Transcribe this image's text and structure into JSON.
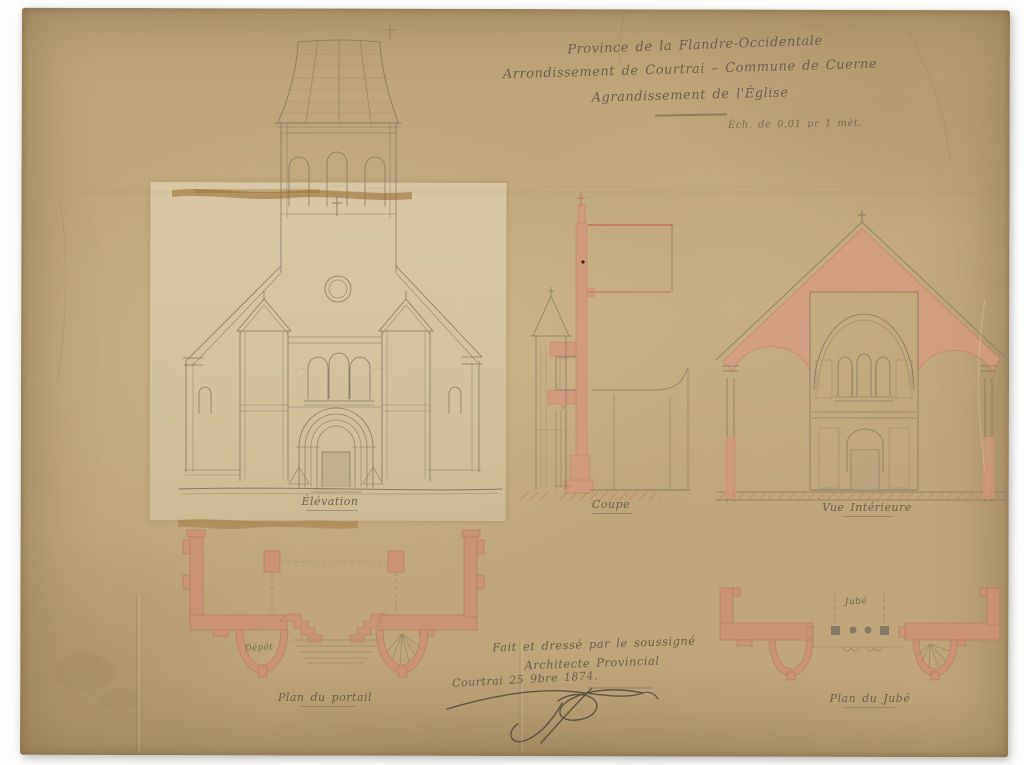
{
  "document_type": "architectural-drawing-scan",
  "titles": {
    "line1": "Province de la Flandre-Occidentale",
    "line2": "Arrondissement de Courtrai – Commune de Cuerne",
    "line3": "Agrandissement de l'Église",
    "scale_note": "Éch. de 0,01 pr 1 mèt."
  },
  "labels": {
    "elevation": "Élévation",
    "coupe": "Coupe",
    "vue_interieure": "Vue Intérieure",
    "plan_portail": "Plan du portail",
    "plan_jube": "Plan du Jubé",
    "depot": "Dépôt",
    "jube": "Jubé"
  },
  "attestation": {
    "line1": "Fait et dressé par le soussigné",
    "line2": "Architecte Provincial",
    "date": "Courtrai 25 9bre 1874."
  },
  "colors": {
    "paper": "#bfa67b",
    "pasted_panel": "#d8c9a6",
    "wash_pink": "#d5987e",
    "pencil": "#847a68",
    "ink": "#5f564a",
    "tape_stain": "#9b7334",
    "background": "#ffffff"
  }
}
